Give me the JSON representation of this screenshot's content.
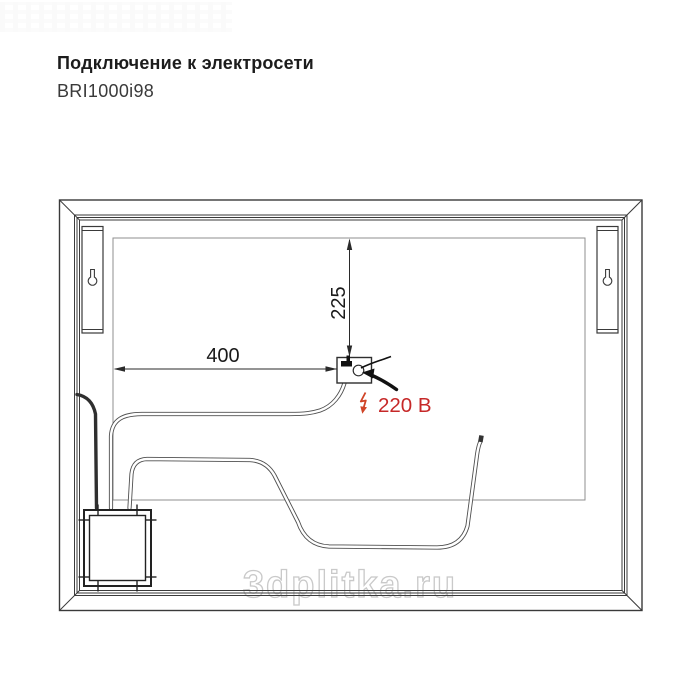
{
  "header": {
    "title": "Подключение к электросети",
    "model": "BRI1000i98"
  },
  "diagram": {
    "dim_horizontal": "400",
    "dim_vertical": "225",
    "power_label": "220 В",
    "colors": {
      "accent_red": "#c62828",
      "lightning_red": "#d04427",
      "line_dark": "#3a3a3a",
      "panel_gray": "#8f8f8f",
      "watermark_gray": "#c9c9c9"
    },
    "icons": {
      "keyhole": "keyhole-icon",
      "lightning": "lightning-icon",
      "pointer": "pointer-arrow-icon"
    }
  },
  "watermark": {
    "text": "3dplitka.ru"
  }
}
